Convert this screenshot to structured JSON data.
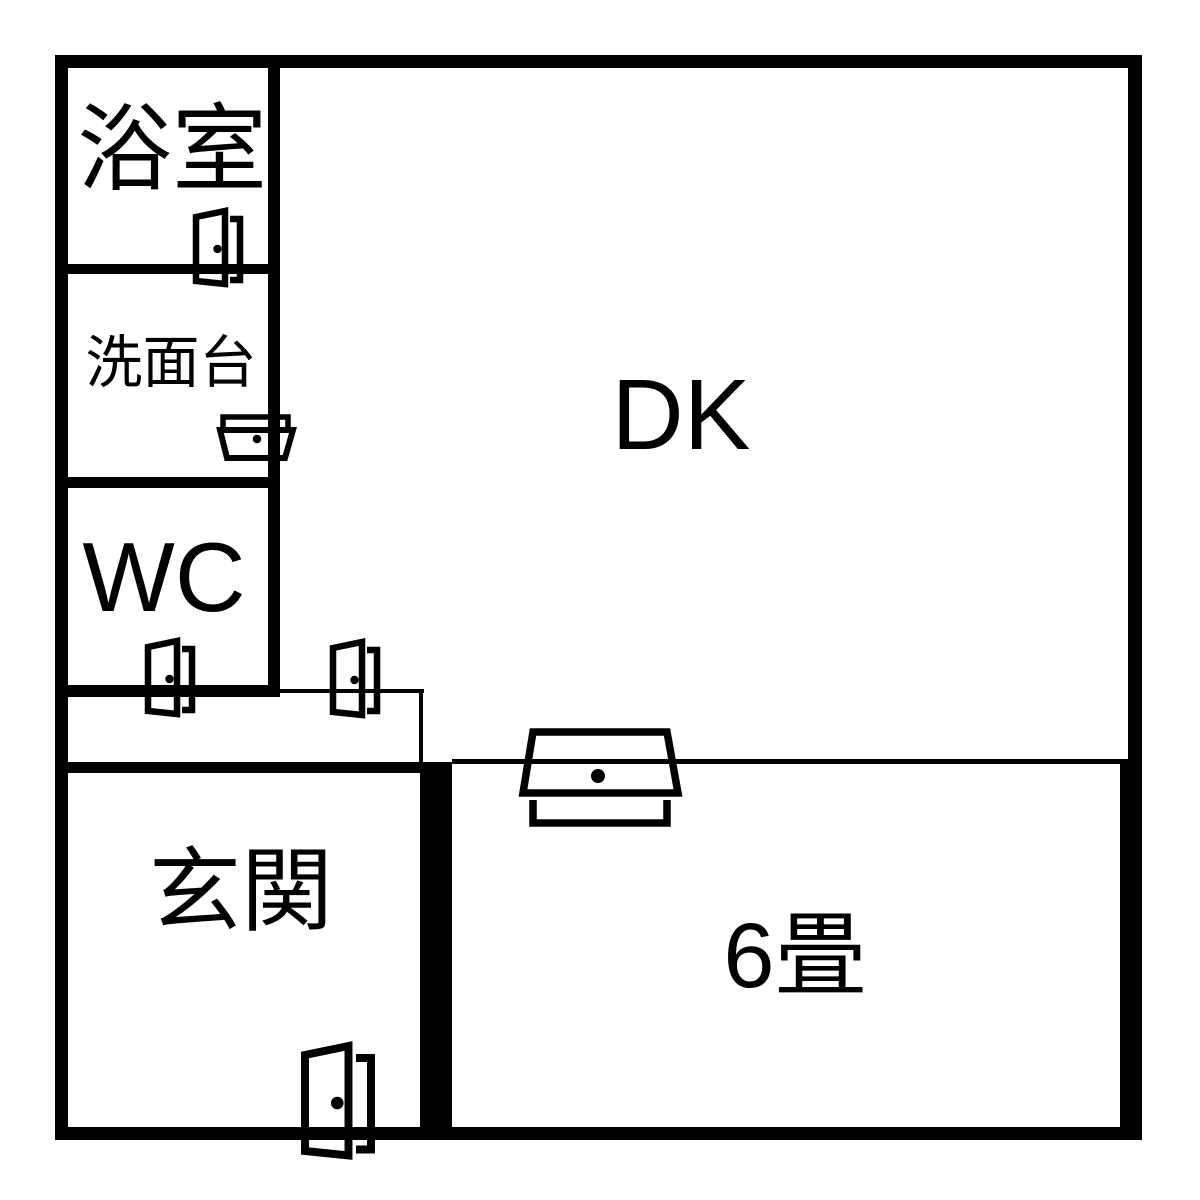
{
  "colors": {
    "background": "#ffffff",
    "line": "#000000"
  },
  "rooms": {
    "bathroom": {
      "label": "浴室"
    },
    "washstand": {
      "label": "洗面台"
    },
    "wc": {
      "label": "WC"
    },
    "dk": {
      "label": "DK"
    },
    "genkan": {
      "label": "玄関"
    },
    "room6": {
      "label": "6畳"
    }
  }
}
